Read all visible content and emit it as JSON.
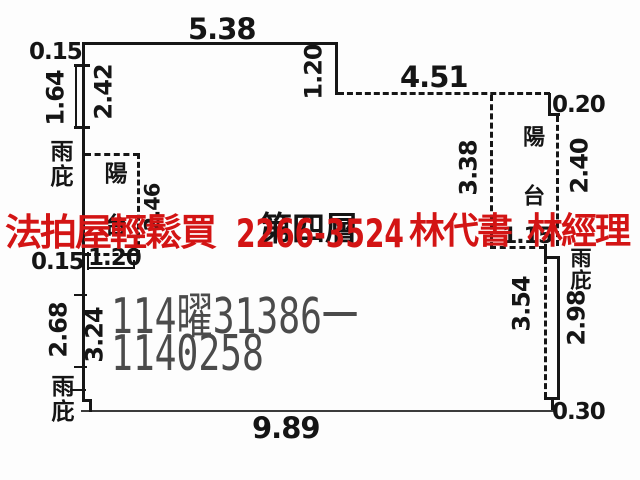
{
  "overlay_ad": {
    "text_left": "法拍屋輕鬆買",
    "phone": "2266-3524",
    "text_mid": "林代書",
    "text_right": "林經理",
    "color": "#d31414"
  },
  "watermark": {
    "line1": "114曜31386一",
    "line2": "1140258",
    "color": "#4b4b4b"
  },
  "plan": {
    "floor_label": "第四層",
    "balcony_left_label": "陽台",
    "balcony_right_label": "陽台",
    "canopy_top_left_label": "雨庇",
    "canopy_bottom_left_label": "雨庇",
    "canopy_right_label": "雨庇",
    "dims": {
      "top_edge": "5.38",
      "top_left_offset": "0.15",
      "top_step": "1.20",
      "top_right_edge": "4.51",
      "right_step": "0.20",
      "left_canopy_height": "1.64",
      "left_wall_upper": "2.42",
      "left_balcony_height": "2.46",
      "left_balcony_width": "1.20",
      "left_lower_offset": "0.15",
      "left_canopy_lower_height": "2.68",
      "left_wall_lower": "3.24",
      "right_balcony_height": "3.38",
      "right_balcony_side": "2.40",
      "right_balcony_bottom": "1.15",
      "right_wall_lower": "3.54",
      "right_canopy_height": "2.98",
      "bottom_right_step": "0.30",
      "bottom_edge": "9.89"
    }
  }
}
